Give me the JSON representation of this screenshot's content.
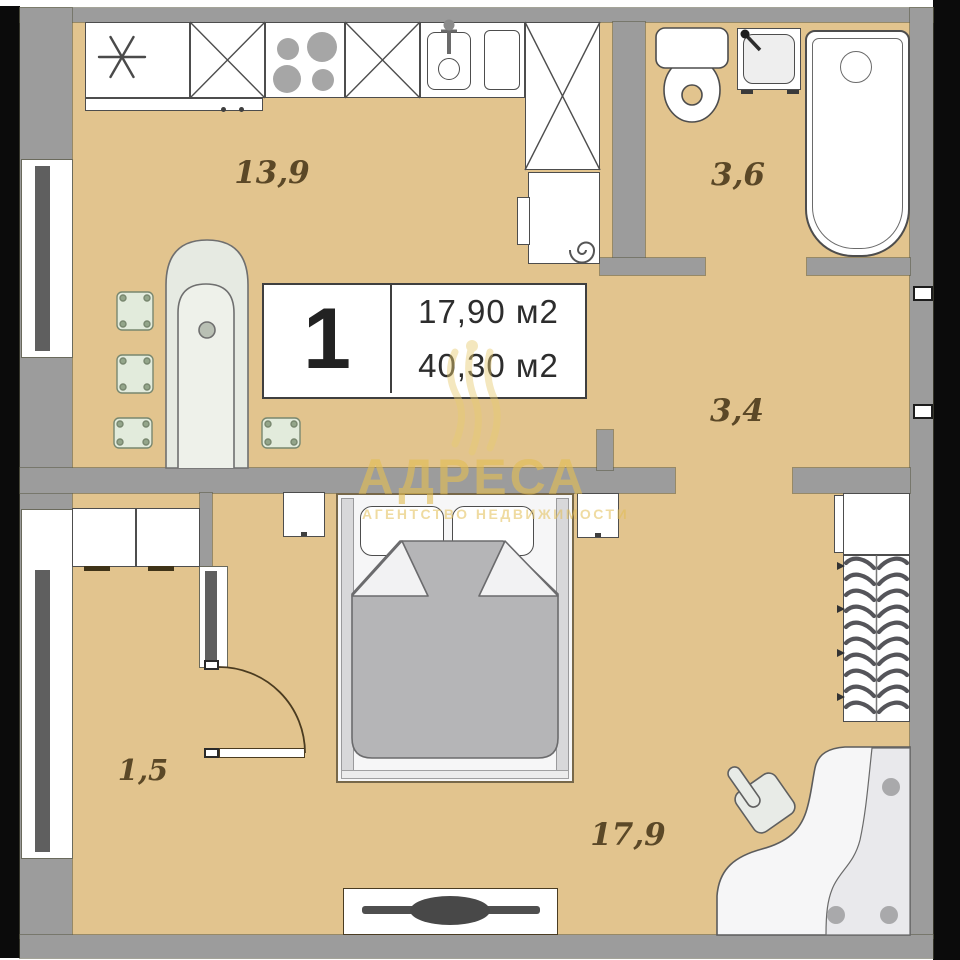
{
  "unit_card": {
    "rooms_count": "1",
    "living_area": "17,90 м2",
    "total_area": "40,30 м2"
  },
  "areas": {
    "kitchen_living": "13,9",
    "bathroom": "3,6",
    "hallway": "3,4",
    "balcony": "1,5",
    "bedroom": "17,9"
  },
  "watermark": {
    "brand": "АДРЕСА",
    "tagline": "АГЕНТСТВО НЕДВИЖИМОСТИ"
  },
  "palette": {
    "floor": "#e2c48e",
    "wall": "#9c9c9c",
    "wall_dark": "#5f5f5f",
    "outline": "#4d4d4d",
    "fixture": "#ffffff",
    "blanket": "#b5b5b7",
    "accent_watermark": "#e3be55",
    "photo_edge": "#0b0b0b",
    "label_text": "#5b4827",
    "card_text": "#2d2d2d"
  }
}
